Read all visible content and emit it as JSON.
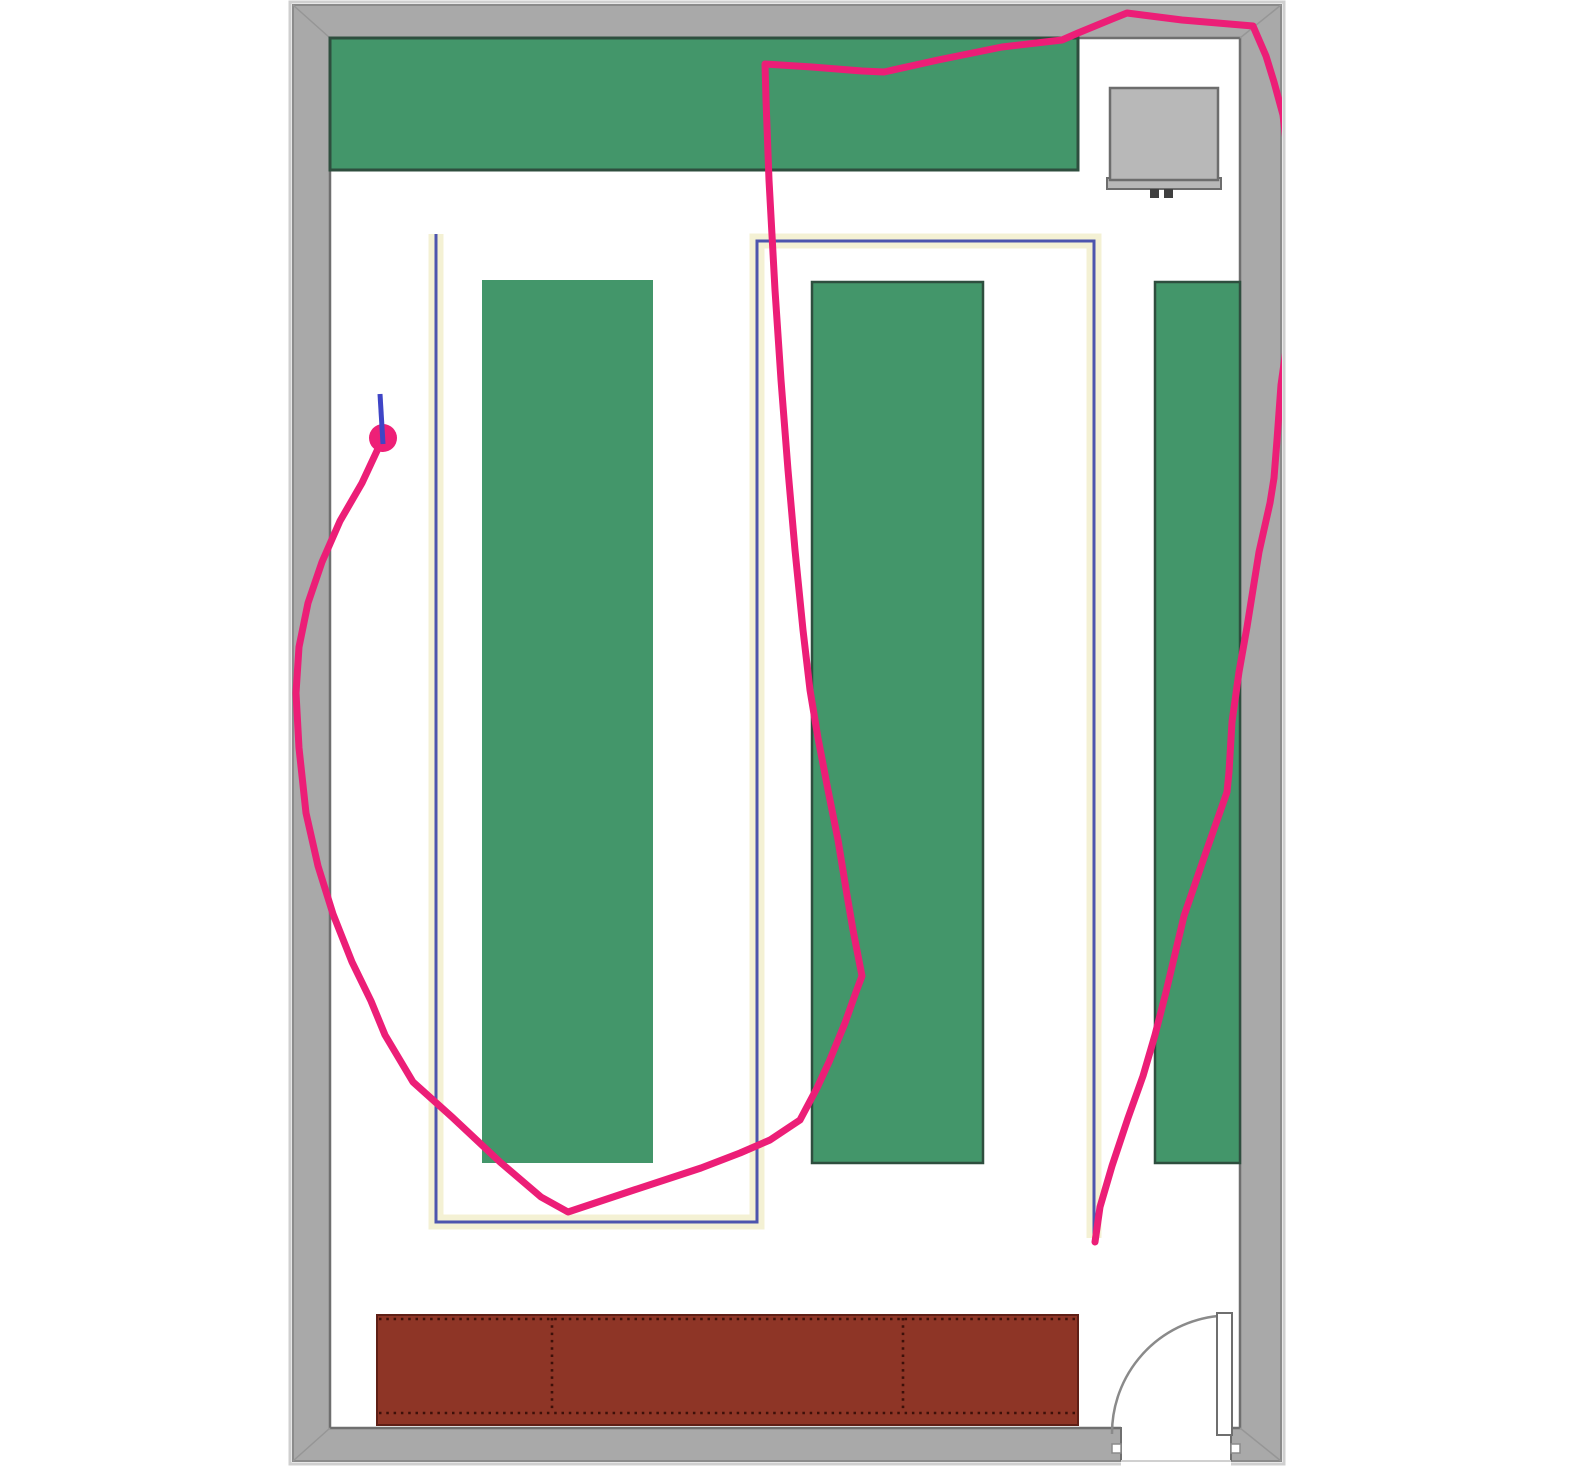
{
  "canvas": {
    "width": 1575,
    "height": 1470,
    "background": "#ffffff",
    "clip_x": 1282
  },
  "colors": {
    "wall_fill": "#a9a9a9",
    "wall_outer_glow": "#cfcfcf",
    "wall_edge_dark": "#8b8b8b",
    "wall_inner_edge": "#6f6f6f",
    "miter": "#969696",
    "floor": "#ffffff",
    "shelf_green": "#43966a",
    "shelf_border": "#2e4e3e",
    "counter_brown": "#8e3526",
    "counter_border": "#5f1f16",
    "counter_dots": "#3d1009",
    "equipment_fill": "#b8b8b8",
    "equipment_border": "#6d6d6d",
    "equipment_feet": "#3f3f3f",
    "route_blue": "#4d55ae",
    "route_halo_yellow": "#f4f1d4",
    "trail_pink": "#ec1e77",
    "marker_pink": "#ee2077",
    "heading_blue": "#3f45c6",
    "door_line": "#8a8a8a",
    "threshold_light": "#d0d0d0"
  },
  "robot": {
    "x": 383,
    "y": 438,
    "radius": 14,
    "heading_from": [
      383,
      444
    ],
    "heading_to": [
      380,
      394
    ]
  },
  "planned_route_points": [
    [
      436,
      234
    ],
    [
      436,
      1222
    ],
    [
      757,
      1222
    ],
    [
      757,
      241
    ],
    [
      1094,
      241
    ],
    [
      1094,
      1238
    ]
  ],
  "trail_points": [
    [
      383,
      438
    ],
    [
      362,
      483
    ],
    [
      340,
      521
    ],
    [
      322,
      562
    ],
    [
      308,
      603
    ],
    [
      299,
      647
    ],
    [
      296,
      693
    ],
    [
      299,
      748
    ],
    [
      306,
      813
    ],
    [
      318,
      866
    ],
    [
      333,
      914
    ],
    [
      352,
      962
    ],
    [
      371,
      1001
    ],
    [
      385,
      1035
    ],
    [
      413,
      1082
    ],
    [
      452,
      1117
    ],
    [
      500,
      1162
    ],
    [
      541,
      1197
    ],
    [
      568,
      1212
    ],
    [
      634,
      1190
    ],
    [
      701,
      1168
    ],
    [
      740,
      1153
    ],
    [
      770,
      1140
    ],
    [
      800,
      1120
    ],
    [
      817,
      1088
    ],
    [
      829,
      1062
    ],
    [
      845,
      1023
    ],
    [
      856,
      992
    ],
    [
      862,
      976
    ],
    [
      853,
      930
    ],
    [
      847,
      895
    ],
    [
      838,
      840
    ],
    [
      828,
      790
    ],
    [
      818,
      738
    ],
    [
      810,
      690
    ],
    [
      803,
      630
    ],
    [
      795,
      550
    ],
    [
      788,
      470
    ],
    [
      781,
      380
    ],
    [
      775,
      290
    ],
    [
      769,
      180
    ],
    [
      766,
      100
    ],
    [
      765,
      64
    ],
    [
      812,
      67
    ],
    [
      862,
      71
    ],
    [
      884,
      72
    ],
    [
      938,
      60
    ],
    [
      1002,
      47
    ],
    [
      1062,
      40
    ],
    [
      1078,
      33
    ],
    [
      1112,
      19
    ],
    [
      1127,
      13
    ],
    [
      1182,
      20
    ],
    [
      1253,
      26
    ],
    [
      1266,
      56
    ],
    [
      1274,
      82
    ],
    [
      1283,
      115
    ],
    [
      1291,
      185
    ],
    [
      1294,
      265
    ],
    [
      1288,
      335
    ],
    [
      1281,
      385
    ],
    [
      1277,
      440
    ],
    [
      1274,
      478
    ],
    [
      1270,
      503
    ],
    [
      1259,
      552
    ],
    [
      1247,
      627
    ],
    [
      1239,
      672
    ],
    [
      1232,
      722
    ],
    [
      1229,
      772
    ],
    [
      1227,
      792
    ],
    [
      1206,
      852
    ],
    [
      1184,
      916
    ],
    [
      1166,
      992
    ],
    [
      1155,
      1035
    ],
    [
      1143,
      1076
    ],
    [
      1128,
      1118
    ],
    [
      1112,
      1166
    ],
    [
      1100,
      1207
    ],
    [
      1095,
      1242
    ]
  ],
  "scene": [
    {
      "name": "wall-outer-glow",
      "kind": "rect",
      "x": 290,
      "y": 2,
      "w": 994,
      "h": 1462,
      "fill": "none",
      "stroke": "@wall_outer_glow",
      "sw": 3,
      "interactable": false
    },
    {
      "name": "wall-frame",
      "kind": "rect",
      "x": 293,
      "y": 5,
      "w": 988,
      "h": 1456,
      "fill": "@wall_fill",
      "stroke": "@wall_edge_dark",
      "sw": 2,
      "interactable": false
    },
    {
      "name": "floor",
      "kind": "rect",
      "x": 330,
      "y": 38,
      "w": 910,
      "h": 1390,
      "fill": "@floor",
      "stroke": "@wall_inner_edge",
      "sw": 2.5,
      "interactable": false
    },
    {
      "name": "corner-miter-top-left",
      "kind": "line",
      "x1": 293,
      "y1": 5,
      "x2": 330,
      "y2": 38,
      "stroke": "@miter",
      "sw": 1.5,
      "interactable": false
    },
    {
      "name": "corner-miter-top-right",
      "kind": "line",
      "x1": 1281,
      "y1": 5,
      "x2": 1240,
      "y2": 38,
      "stroke": "@miter",
      "sw": 1.5,
      "interactable": false
    },
    {
      "name": "corner-miter-bottom-left",
      "kind": "line",
      "x1": 293,
      "y1": 1461,
      "x2": 330,
      "y2": 1428,
      "stroke": "@miter",
      "sw": 1.5,
      "interactable": false
    },
    {
      "name": "corner-miter-bottom-right",
      "kind": "line",
      "x1": 1281,
      "y1": 1461,
      "x2": 1240,
      "y2": 1428,
      "stroke": "@miter",
      "sw": 1.5,
      "interactable": false
    },
    {
      "name": "shelf-top-bar",
      "kind": "rect",
      "x": 330,
      "y": 38,
      "w": 748,
      "h": 132,
      "fill": "@shelf_green",
      "stroke": "@shelf_border",
      "sw": 3,
      "interactable": false
    },
    {
      "name": "shelf-column-1",
      "kind": "rect",
      "x": 482,
      "y": 280,
      "w": 171,
      "h": 883,
      "fill": "@shelf_green",
      "stroke": "none",
      "sw": 0,
      "interactable": false
    },
    {
      "name": "shelf-column-2",
      "kind": "rect",
      "x": 812,
      "y": 282,
      "w": 171,
      "h": 881,
      "fill": "@shelf_green",
      "stroke": "@shelf_border",
      "sw": 2.5,
      "interactable": false
    },
    {
      "name": "shelf-column-3",
      "kind": "rect",
      "x": 1155,
      "y": 282,
      "w": 85,
      "h": 881,
      "fill": "@shelf_green",
      "stroke": "@shelf_border",
      "sw": 2.5,
      "interactable": false
    },
    {
      "name": "equipment-tray",
      "kind": "rect",
      "x": 1107,
      "y": 178,
      "w": 114,
      "h": 11,
      "fill": "@equipment_fill",
      "stroke": "@equipment_border",
      "sw": 2,
      "interactable": false
    },
    {
      "name": "equipment-box",
      "kind": "rect",
      "x": 1110,
      "y": 88,
      "w": 108,
      "h": 92,
      "fill": "@equipment_fill",
      "stroke": "@equipment_border",
      "sw": 2.5,
      "interactable": false
    },
    {
      "name": "equipment-foot-left",
      "kind": "rect",
      "x": 1150,
      "y": 189,
      "w": 9,
      "h": 9,
      "fill": "@equipment_feet",
      "stroke": "none",
      "sw": 0,
      "interactable": false
    },
    {
      "name": "equipment-foot-right",
      "kind": "rect",
      "x": 1164,
      "y": 189,
      "w": 9,
      "h": 9,
      "fill": "@equipment_feet",
      "stroke": "none",
      "sw": 0,
      "interactable": false
    },
    {
      "name": "counter",
      "kind": "rect",
      "x": 377,
      "y": 1315,
      "w": 701,
      "h": 110,
      "fill": "@counter_brown",
      "stroke": "@counter_border",
      "sw": 2,
      "interactable": false
    },
    {
      "name": "counter-dots-top",
      "kind": "line",
      "x1": 379,
      "y1": 1319,
      "x2": 1076,
      "y2": 1319,
      "stroke": "@counter_dots",
      "sw": 2.6,
      "dash": "2.5 4.8",
      "interactable": false
    },
    {
      "name": "counter-dots-bottom",
      "kind": "line",
      "x1": 379,
      "y1": 1413,
      "x2": 1076,
      "y2": 1413,
      "stroke": "@counter_dots",
      "sw": 2.6,
      "dash": "2.5 4.8",
      "interactable": false
    },
    {
      "name": "counter-divider-dots-1",
      "kind": "line",
      "x1": 552,
      "y1": 1318,
      "x2": 552,
      "y2": 1412,
      "stroke": "@counter_dots",
      "sw": 2.6,
      "dash": "2.5 4.8",
      "interactable": false
    },
    {
      "name": "counter-divider-dots-2",
      "kind": "line",
      "x1": 903,
      "y1": 1318,
      "x2": 903,
      "y2": 1412,
      "stroke": "@counter_dots",
      "sw": 2.6,
      "dash": "2.5 4.8",
      "interactable": false
    },
    {
      "name": "door-opening",
      "kind": "rect",
      "x": 1121,
      "y": 1426,
      "w": 110,
      "h": 44,
      "fill": "@floor",
      "stroke": "none",
      "sw": 0,
      "interactable": false
    },
    {
      "name": "door-jamb-left",
      "kind": "line",
      "x1": 1121,
      "y1": 1427,
      "x2": 1121,
      "y2": 1461,
      "stroke": "@wall_inner_edge",
      "sw": 2,
      "interactable": false
    },
    {
      "name": "door-jamb-right",
      "kind": "line",
      "x1": 1231,
      "y1": 1427,
      "x2": 1231,
      "y2": 1461,
      "stroke": "@wall_inner_edge",
      "sw": 2,
      "interactable": false
    },
    {
      "name": "door-threshold",
      "kind": "line",
      "x1": 1121,
      "y1": 1461,
      "x2": 1231,
      "y2": 1461,
      "stroke": "@threshold_light",
      "sw": 2,
      "interactable": false
    },
    {
      "name": "door-notch-left",
      "kind": "rect",
      "x": 1112,
      "y": 1444,
      "w": 9,
      "h": 9,
      "fill": "@floor",
      "stroke": "@door_line",
      "sw": 1.5,
      "interactable": false
    },
    {
      "name": "door-notch-right",
      "kind": "rect",
      "x": 1231,
      "y": 1444,
      "w": 9,
      "h": 9,
      "fill": "@floor",
      "stroke": "@door_line",
      "sw": 1.5,
      "interactable": false
    },
    {
      "name": "door-swing-arc",
      "kind": "path",
      "d": "M 1218,1316 A 118 118 0 0 0 1112,1434",
      "fill": "none",
      "stroke": "@door_line",
      "sw": 2.5,
      "interactable": false
    },
    {
      "name": "door-leaf",
      "kind": "rect",
      "x": 1217,
      "y": 1313,
      "w": 15,
      "h": 122,
      "fill": "@floor",
      "stroke": "@wall_inner_edge",
      "sw": 2,
      "interactable": false
    },
    {
      "name": "route-halo",
      "kind": "polyline",
      "pointsRef": "planned_route_points",
      "fill": "none",
      "stroke": "@route_halo_yellow",
      "sw": 15,
      "join": "miter",
      "cap": "butt",
      "interactable": false
    },
    {
      "name": "planned-route",
      "kind": "polyline",
      "pointsRef": "planned_route_points",
      "fill": "none",
      "stroke": "@route_blue",
      "sw": 3,
      "join": "miter",
      "cap": "butt",
      "interactable": false
    },
    {
      "name": "trail",
      "kind": "polyline",
      "pointsRef": "trail_points",
      "fill": "none",
      "stroke": "@trail_pink",
      "sw": 7,
      "join": "round",
      "cap": "round",
      "clip": true,
      "interactable": false
    },
    {
      "name": "robot-marker",
      "kind": "circle",
      "cx": 383,
      "cy": 438,
      "r": 14,
      "fill": "@marker_pink",
      "stroke": "none",
      "sw": 0,
      "interactable": true
    },
    {
      "name": "robot-heading",
      "kind": "line",
      "x1": 383,
      "y1": 444,
      "x2": 380,
      "y2": 394,
      "stroke": "@heading_blue",
      "sw": 5,
      "interactable": false
    }
  ]
}
